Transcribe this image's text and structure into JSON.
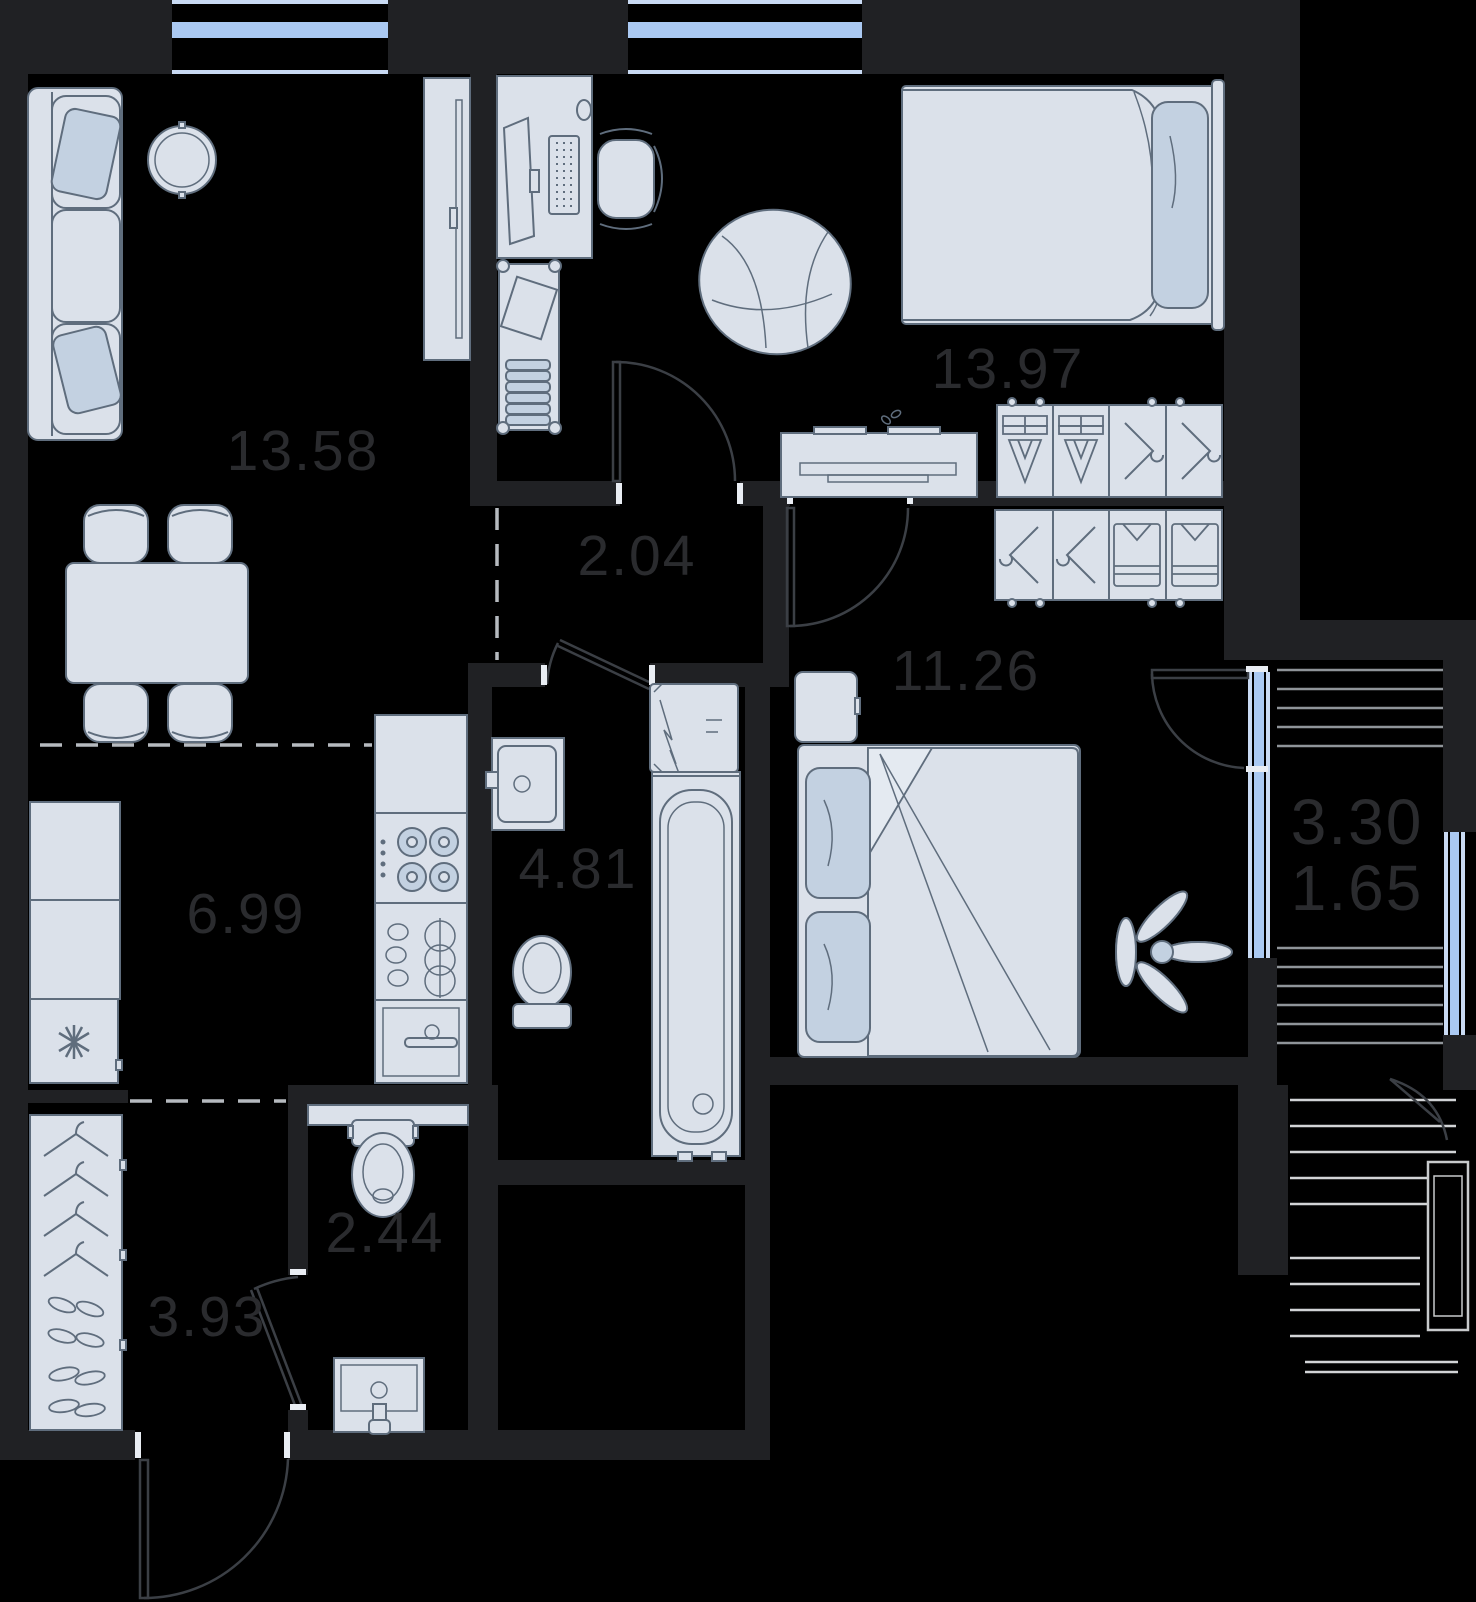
{
  "plan": {
    "type": "apartment-floor-plan",
    "rooms": {
      "living_dining": {
        "area": "13.58"
      },
      "hallway": {
        "area": "2.04"
      },
      "bedroom_main": {
        "area": "13.97"
      },
      "bedroom_second": {
        "area": "11.26"
      },
      "kitchen": {
        "area": "6.99"
      },
      "bathroom": {
        "area": "4.81"
      },
      "wc": {
        "area": "2.44"
      },
      "entrance": {
        "area": "3.93"
      },
      "balcony": {
        "area_total": "3.30",
        "area_counted": "1.65"
      }
    },
    "colors": {
      "background": "#000000",
      "wall": "#202124",
      "furniture_fill": "#dbe1ea",
      "furniture_stroke": "#5f6d7d",
      "pillow_fill": "#c3d1e1",
      "window_glass": "#aac9f2",
      "balcony_hatch": "#8f9499",
      "balcony_hatch_light": "#d2d4d6",
      "label_text": "#2a2b2e"
    },
    "icons": [
      "sofa",
      "round-pouf",
      "dining-table",
      "chair",
      "tv-panel",
      "desk",
      "monitor",
      "keyboard",
      "office-chair",
      "bookshelf",
      "bed",
      "pillow",
      "dresser",
      "wardrobe",
      "hanger-icon",
      "folded-clothes-icon",
      "shirt-icon",
      "fridge",
      "snowflake-icon",
      "stove-burners",
      "kitchen-sink",
      "kitchen-cabinet",
      "washing-machine",
      "bathtub",
      "toilet",
      "wash-basin",
      "plant",
      "door-swing",
      "window",
      "balcony-hatch",
      "ac-unit",
      "shoes-icon"
    ]
  }
}
